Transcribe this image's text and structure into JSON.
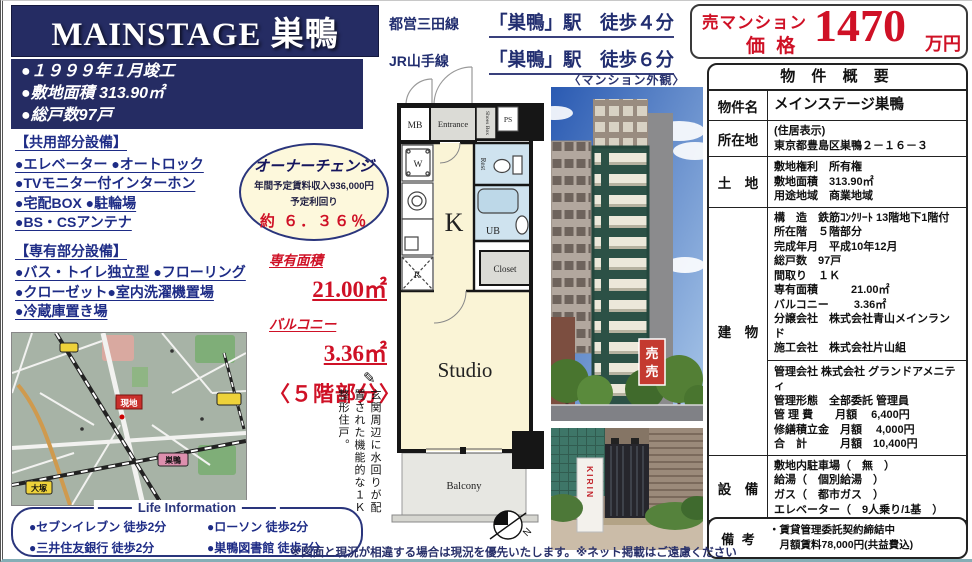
{
  "page": {
    "title_banner": "MAINSTAGE 巣鴨",
    "disclaimer": "※図面と現況が相違する場合は現況を優先いたします。※ネット掲載はご遠慮ください"
  },
  "building_facts": [
    "●１９９９年１月竣工",
    "●敷地面積 313.90㎡",
    "●総戸数97戸"
  ],
  "access": [
    {
      "line": "都営三田線",
      "station": "「巣鴨」駅　徒歩４分"
    },
    {
      "line": "JR山手線",
      "station": "「巣鴨」駅　徒歩６分"
    }
  ],
  "price": {
    "category": "売マンション",
    "label": "価 格",
    "amount": "1470",
    "unit": "万円"
  },
  "equipment": {
    "shared_title": "【共用部分設備】",
    "shared_items": [
      "●エレベーター ●オートロック",
      "●TVモニター付インターホン",
      "●宅配BOX ●駐輪場",
      "●BS・CSアンテナ"
    ],
    "private_title": "【専有部分設備】",
    "private_items": [
      "●バス・トイレ独立型 ●フローリング",
      "●クローゼット●室内洗濯機置場",
      "●冷蔵庫置き場"
    ]
  },
  "owner_change": {
    "title": "オーナーチェンジ",
    "income": "年間予定賃料収入936,000円",
    "yield_label": "予定利回り",
    "yield_value": "約 ６．３６％"
  },
  "unit_area": {
    "label1": "専有面積",
    "value1": "21.00㎡",
    "label2": "バルコニー",
    "value2": "3.36㎡",
    "floor_note": "〈５階部分〉",
    "pencil_icon": "✎"
  },
  "vertical_note": "玄関周辺に水回りが配置された機能的な１Ｋ整形住戸。",
  "floorplan": {
    "mb": "MB",
    "entrance": "Entrance",
    "shoes_box": "Shoes Box",
    "ps": "PS",
    "w": "W",
    "rest": "Rest",
    "kitchen": "K",
    "ub": "UB",
    "fridge": "R",
    "closet": "Closet",
    "studio": "Studio",
    "balcony": "Balcony",
    "north": "N"
  },
  "photos": {
    "exterior_caption": "〈マンション外観〉",
    "sale_sign": "売",
    "vending_brand": "KIRIN"
  },
  "map": {
    "site_label": "現地",
    "station_otsuka": "大塚",
    "station_sugamo": "巣鴨"
  },
  "overview": {
    "header": "物 件 概 要",
    "rows": [
      {
        "label": "物件名",
        "emphasis": true,
        "lines": [
          "メインステージ巣鴨"
        ]
      },
      {
        "label": "所在地",
        "lines": [
          "(住居表示)",
          "東京都豊島区巣鴨２－１６－３"
        ]
      },
      {
        "label": "土　地",
        "lines": [
          "敷地権利　所有権",
          "敷地面積　313.90㎡",
          "用途地域　商業地域"
        ]
      },
      {
        "label": "建　物",
        "lines": [
          "構　造　鉄筋ｺﾝｸﾘｰﾄ 13階地下1階付",
          "所在階　５階部分",
          "完成年月　平成10年12月",
          "総戸数　97戸",
          "間取り　１Ｋ",
          "専有面積　　　21.00㎡",
          "バルコニー　　 3.36㎡",
          "分譲会社　株式会社青山メインランド",
          "施工会社　株式会社片山組",
          "---",
          "管理会社 株式会社 グランドアメニティ",
          "管理形態　全部委託 管理員",
          "管 理 費　　月額　 6,400円",
          "修繕積立金　月額　 4,000円",
          "合　計　　　月額　10,400円"
        ]
      },
      {
        "label": "設　備",
        "lines": [
          "敷地内駐車場（　無　）",
          "給湯（　個別給湯　）",
          "ガス（　都市ガス　）",
          "エレベーター（　9人乗り/1基　）"
        ]
      },
      {
        "label": "引渡し",
        "lines": [
          "現況（ 賃貸中）　引渡時期 （ 相談 ）"
        ]
      }
    ]
  },
  "remarks": {
    "label": "備 考",
    "lines": [
      "・賃貸管理委託契約締結中",
      "　月額賃料78,000円(共益費込)"
    ]
  },
  "life_info": {
    "title": "Life Information",
    "items": [
      "●セブンイレブン 徒歩2分",
      "●ローソン 徒歩2分",
      "●三井住友銀行 徒歩2分",
      "●巣鴨図書館 徒歩7分"
    ]
  }
}
